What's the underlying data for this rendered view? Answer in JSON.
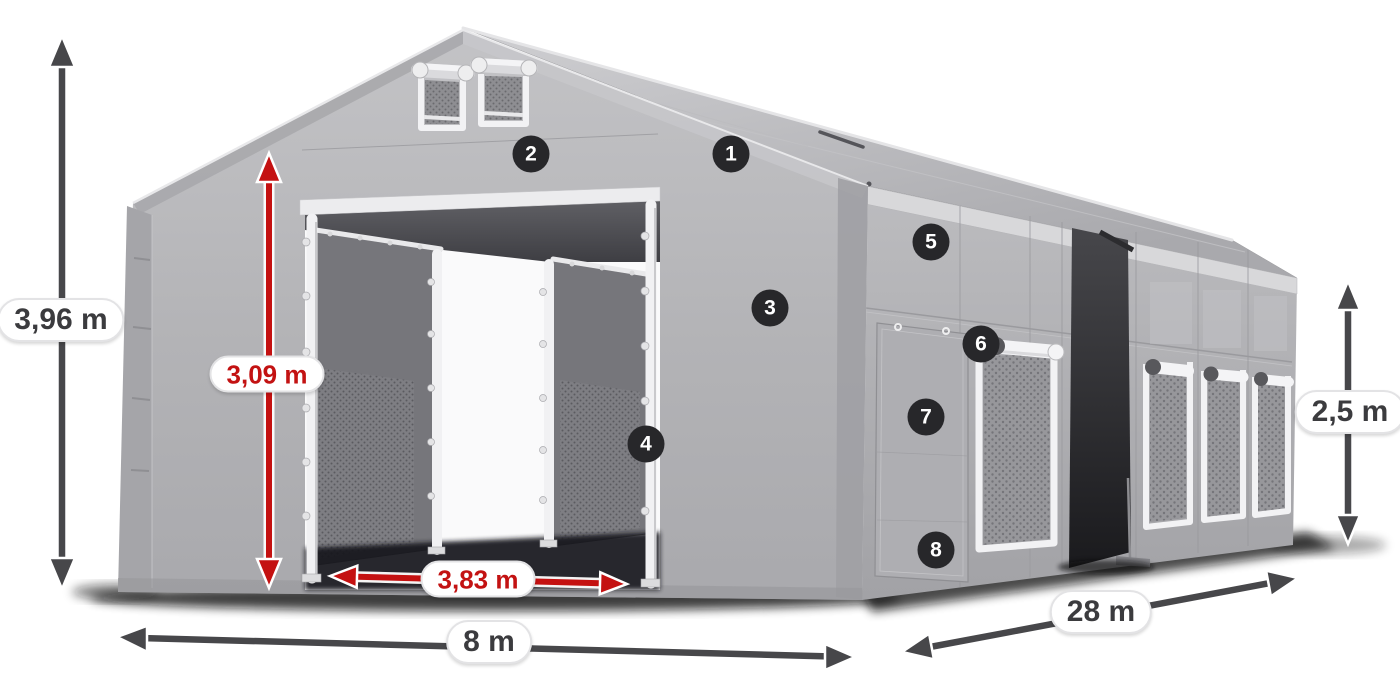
{
  "dimensions": {
    "total_height": "3,96 m",
    "entrance_height": "3,09 m",
    "entrance_width": "3,83 m",
    "gable_width": "8 m",
    "side_length": "28 m",
    "wall_height": "2,5 m"
  },
  "callouts": [
    {
      "number": "1"
    },
    {
      "number": "2"
    },
    {
      "number": "3"
    },
    {
      "number": "4"
    },
    {
      "number": "5"
    },
    {
      "number": "6"
    },
    {
      "number": "7"
    },
    {
      "number": "8"
    }
  ],
  "colors": {
    "accent_red": "#c41111",
    "dimension_gray": "#47474a",
    "badge_background": "#27272a",
    "tent_gray": "#b3b3b6",
    "background": "#ffffff"
  }
}
